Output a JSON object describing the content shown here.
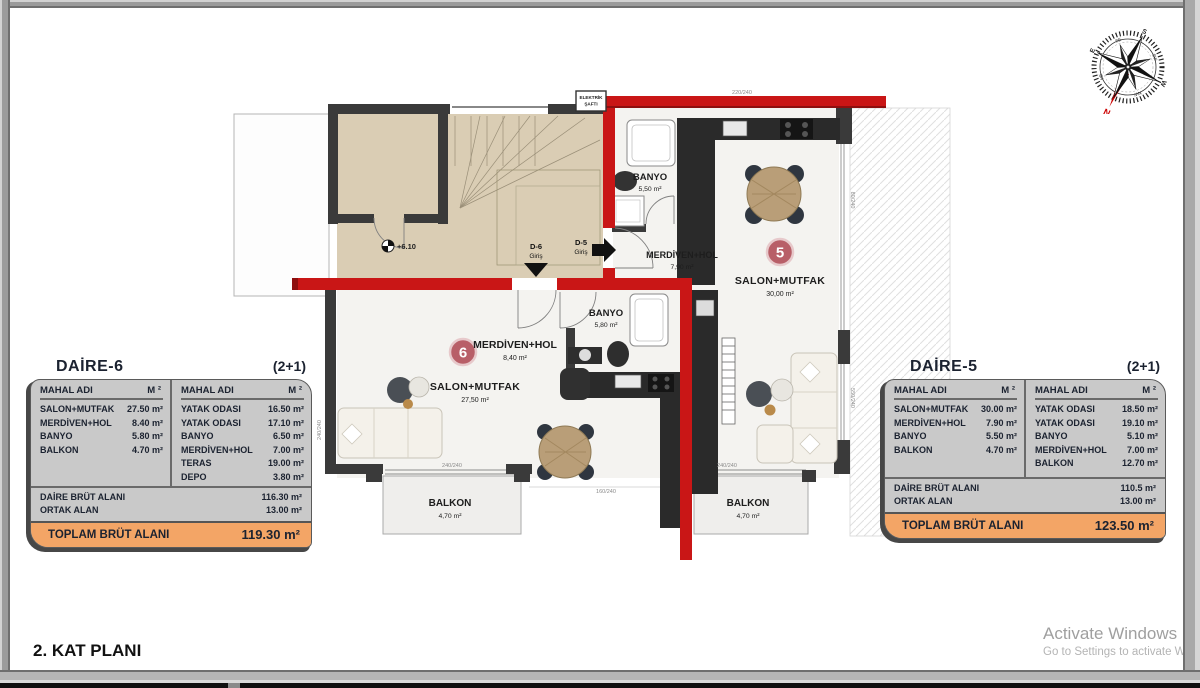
{
  "page": {
    "plan_title": "2. KAT PLANI"
  },
  "watermark": {
    "line1": "Activate Windows",
    "line2": "Go to Settings to activate Window"
  },
  "compass": {
    "n": "N",
    "s": "S",
    "e": "E",
    "w": "W",
    "ne": "NE",
    "nw": "NW",
    "se": "SE",
    "sw": "SW"
  },
  "plan": {
    "common": {
      "level_marker": "+6.10",
      "entry_d6": "D-6",
      "entry_d6_sub": "Giriş",
      "entry_d5": "D-5",
      "entry_d5_sub": "Giriş",
      "shaft_line1": "ELEKTRİK",
      "shaft_line2": "ŞAFTI"
    },
    "unit5": {
      "number": "5",
      "salon": "SALON+MUTFAK",
      "salon_area": "30,00 m²",
      "merdiven": "MERDİVEN+HOL",
      "merdiven_area": "7,90 m²",
      "banyo": "BANYO",
      "banyo_area": "5,50 m²",
      "balkon": "BALKON",
      "balkon_area": "4,70 m²"
    },
    "unit6": {
      "number": "6",
      "salon": "SALON+MUTFAK",
      "salon_area": "27,50 m²",
      "merdiven": "MERDİVEN+HOL",
      "merdiven_area": "8,40 m²",
      "banyo": "BANYO",
      "banyo_area": "5,80 m²",
      "balkon": "BALKON",
      "balkon_area": "4,70 m²"
    },
    "dims": {
      "d1": "220/240",
      "d2": "80/240",
      "d3": "550/240",
      "d4": "240/240",
      "d5": "160/240",
      "d6": "240/240",
      "d7": "240/240"
    }
  },
  "tables": {
    "daire6": {
      "title": "DAİRE-6",
      "type": "(2+1)",
      "col_name": "MAHAL ADI",
      "col_area": "M ²",
      "left": [
        {
          "n": "SALON+MUTFAK",
          "v": "27.50 m²"
        },
        {
          "n": "MERDİVEN+HOL",
          "v": "8.40 m²"
        },
        {
          "n": "BANYO",
          "v": "5.80 m²"
        },
        {
          "n": "BALKON",
          "v": "4.70 m²"
        }
      ],
      "right": [
        {
          "n": "YATAK ODASI",
          "v": "16.50 m²"
        },
        {
          "n": "YATAK ODASI",
          "v": "17.10 m²"
        },
        {
          "n": "BANYO",
          "v": "6.50 m²"
        },
        {
          "n": "MERDİVEN+HOL",
          "v": "7.00 m²"
        },
        {
          "n": "TERAS",
          "v": "19.00 m²"
        },
        {
          "n": "DEPO",
          "v": "3.80 m²"
        }
      ],
      "summary": [
        {
          "n": "DAİRE BRÜT ALANI",
          "v": "116.30 m²"
        },
        {
          "n": "ORTAK ALAN",
          "v": "13.00 m²"
        }
      ],
      "total_label": "TOPLAM BRÜT ALANI",
      "total_value": "119.30 m²"
    },
    "daire5": {
      "title": "DAİRE-5",
      "type": "(2+1)",
      "col_name": "MAHAL ADI",
      "col_area": "M ²",
      "left": [
        {
          "n": "SALON+MUTFAK",
          "v": "30.00 m²"
        },
        {
          "n": "MERDİVEN+HOL",
          "v": "7.90 m²"
        },
        {
          "n": "BANYO",
          "v": "5.50 m²"
        },
        {
          "n": "BALKON",
          "v": "4.70 m²"
        }
      ],
      "right": [
        {
          "n": "YATAK ODASI",
          "v": "18.50 m²"
        },
        {
          "n": "YATAK ODASI",
          "v": "19.10 m²"
        },
        {
          "n": "BANYO",
          "v": "5.10 m²"
        },
        {
          "n": "MERDİVEN+HOL",
          "v": "7.00 m²"
        },
        {
          "n": "BALKON",
          "v": "12.70 m²"
        }
      ],
      "summary": [
        {
          "n": "DAİRE BRÜT ALANI",
          "v": "110.5 m²"
        },
        {
          "n": "ORTAK ALAN",
          "v": "13.00 m²"
        }
      ],
      "total_label": "TOPLAM BRÜT ALANI",
      "total_value": "123.50 m²"
    }
  },
  "colors": {
    "wall_red": "#c91616",
    "wall_dark": "#3a3a3a",
    "accent_orange": "#f3a566",
    "stair_beige": "#dacdb4"
  }
}
